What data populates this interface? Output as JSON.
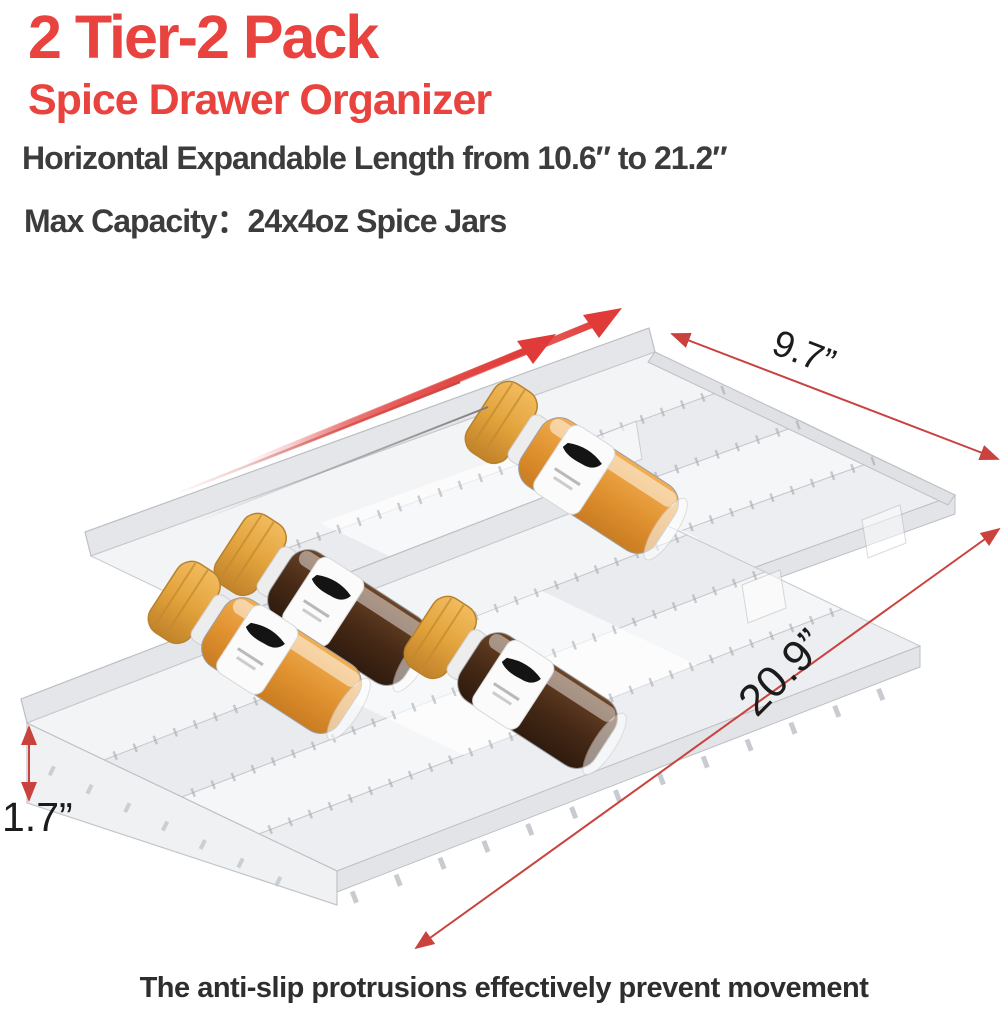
{
  "header": {
    "title_line1": "2 Tier-2 Pack",
    "title_line2": "Spice Drawer Organizer",
    "feature_line1": "Horizontal Expandable Length from  10.6″ to 21.2″",
    "feature_line2": "Max Capacity：24x4oz Spice Jars",
    "accent_color": "#e8433e",
    "text_color": "#3c3c3c"
  },
  "dimensions": {
    "width_label": "9.7”",
    "length_label": "20.9”",
    "height_label": "1.7”",
    "line_color": "#c9423d",
    "label_color": "#1b1b1b"
  },
  "caption": "The anti-slip protrusions effectively prevent movement",
  "product": {
    "type": "expandable 2-tier spice drawer organizer, 2 pack",
    "material_look": "clear frosted plastic with ruler tick marks",
    "tray_count": 2,
    "jars": [
      {
        "id": 1,
        "cap_color": "#dfa03c",
        "contents": "orange spice",
        "contents_color": "#e0912f",
        "label": "white label with black brush mark"
      },
      {
        "id": 2,
        "cap_color": "#dfa03c",
        "contents": "dark brown spice",
        "contents_color": "#4a2c19",
        "label": "white label with black brush mark"
      },
      {
        "id": 3,
        "cap_color": "#dfa03c",
        "contents": "orange spice",
        "contents_color": "#e0912f",
        "label": "white label with black brush mark"
      },
      {
        "id": 4,
        "cap_color": "#dfa03c",
        "contents": "dark brown spice",
        "contents_color": "#4a2c19",
        "label": "white label with black brush mark"
      }
    ],
    "annotation_arrow_color": "#e03b38"
  }
}
